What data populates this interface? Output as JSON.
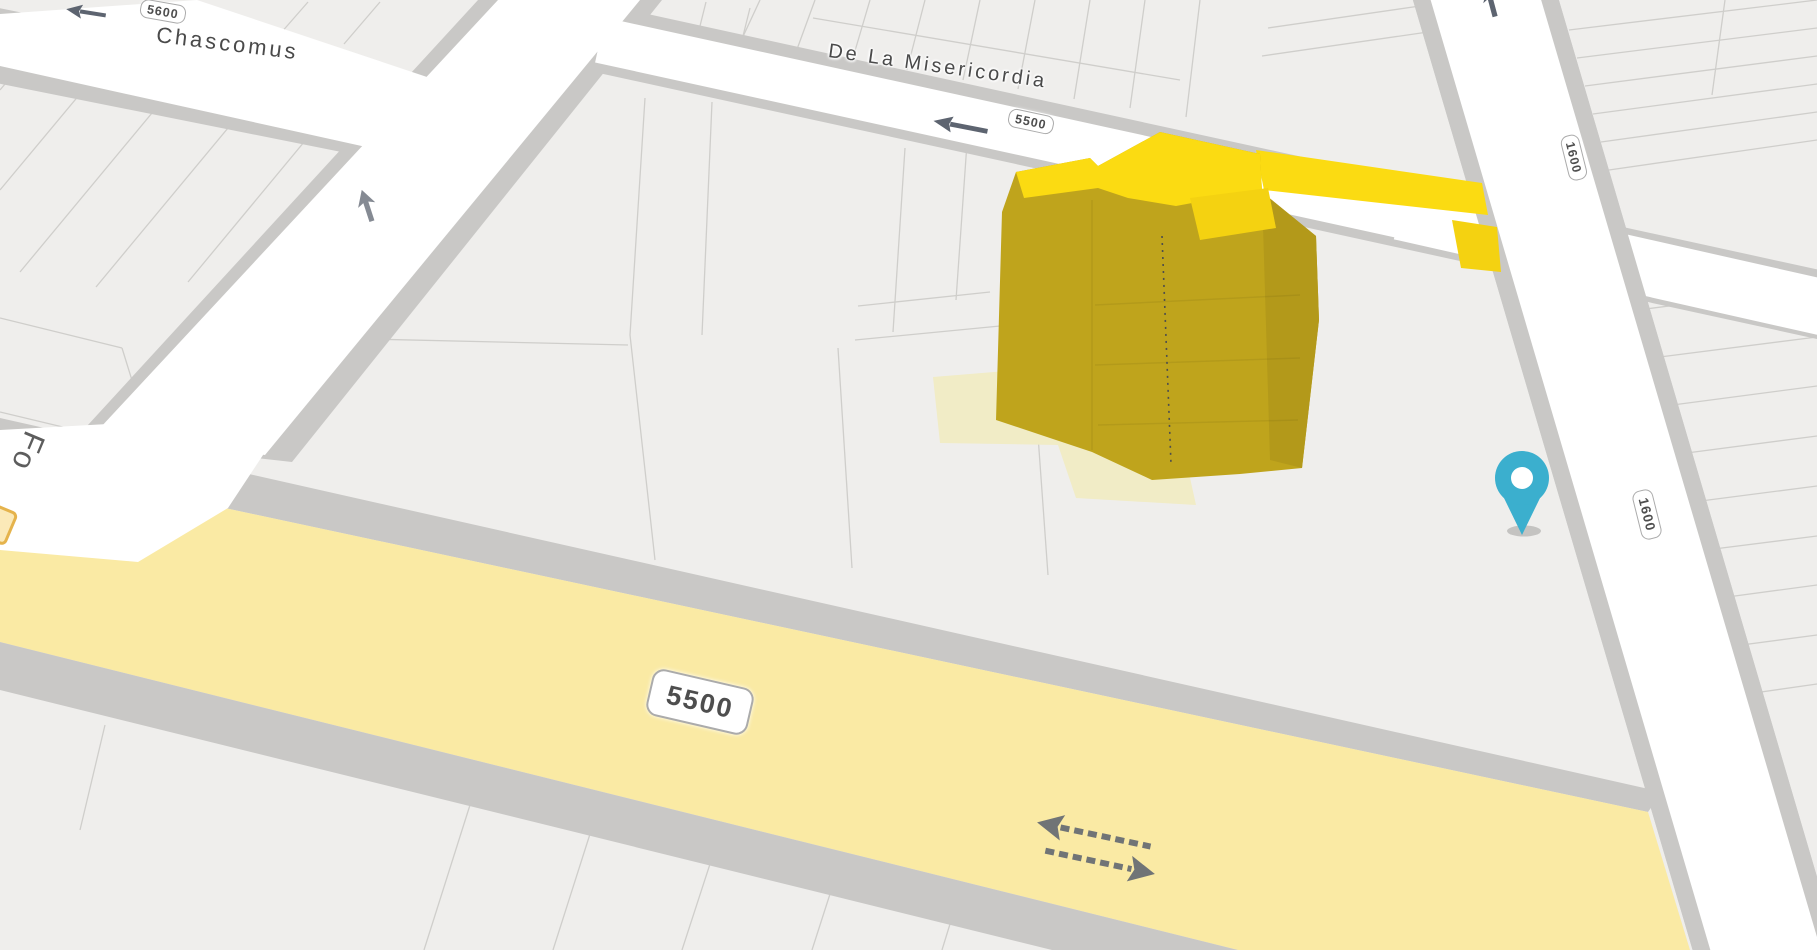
{
  "map": {
    "labels": {
      "chascomus": "Chascomus",
      "misericordia": "De La Misericordia",
      "partial_street": "Fo",
      "shield_5600": "5600",
      "shield_5500_small": "5500",
      "shield_5500_large": "5500",
      "shield_1600_upper": "1600",
      "shield_1600_lower": "1600"
    },
    "marker": {
      "type": "location-pin"
    },
    "features": {
      "highlighted_building": "yellow-3d-extrusion",
      "highlighted_road": "yellow-avenue-5500"
    }
  },
  "colors": {
    "block": "#efeeec",
    "road_white": "#ffffff",
    "casing": "#c9c8c6",
    "parcel_line": "#cfcecb",
    "avenue_yellow": "#faeaa4",
    "building_roof": "#fbdb12",
    "building_roof_alt": "#f4d211",
    "building_side": "#bfa41c",
    "building_side_dark": "#b3991a",
    "building_footprint": "#f1ecc6",
    "marker_teal": "#3bafce",
    "label_text": "#4a4a4a",
    "arrow": "#5d6470"
  }
}
